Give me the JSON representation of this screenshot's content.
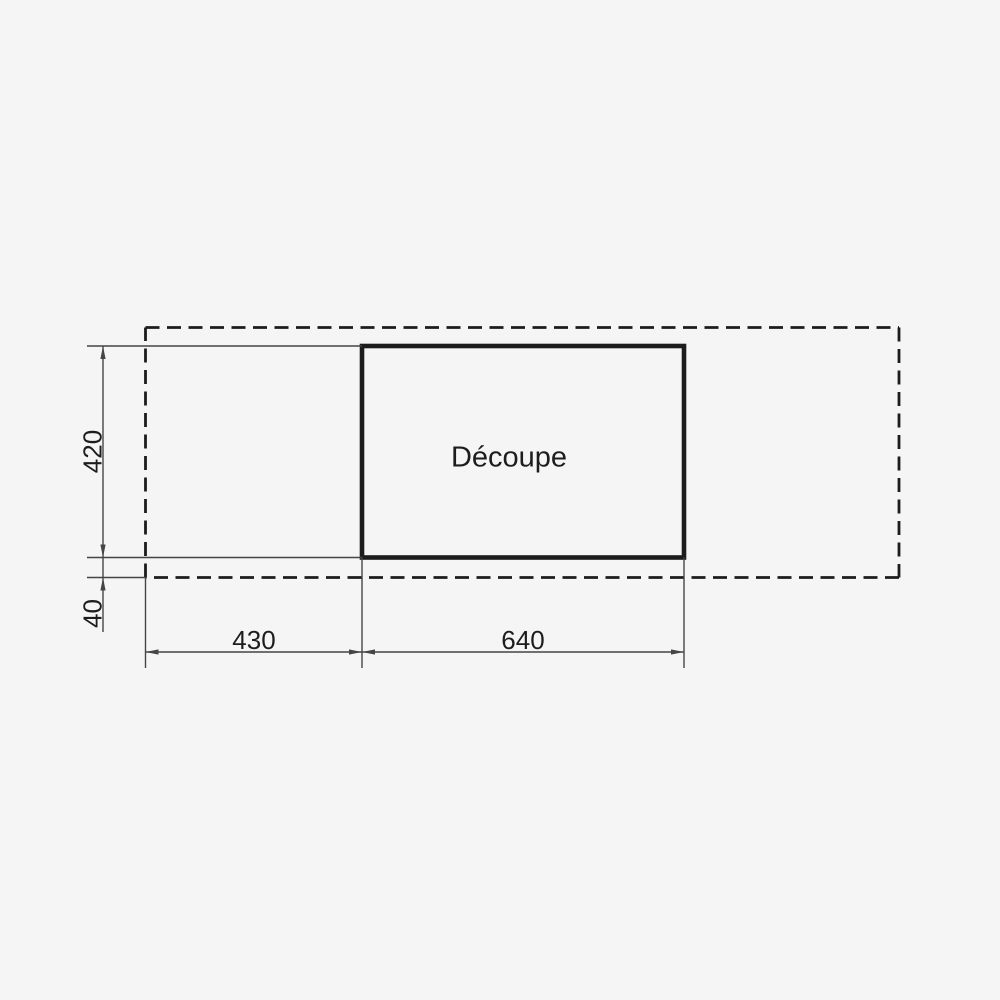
{
  "drawing": {
    "cutout_label": "Découpe",
    "dimensions": {
      "cutout_height": "420",
      "bottom_offset": "40",
      "left_offset": "430",
      "cutout_width": "640"
    }
  },
  "colors": {
    "background": "#f5f5f6",
    "heavy_line": "#1c1c1c",
    "thin_line": "#454545",
    "text": "#1d1d1d"
  }
}
